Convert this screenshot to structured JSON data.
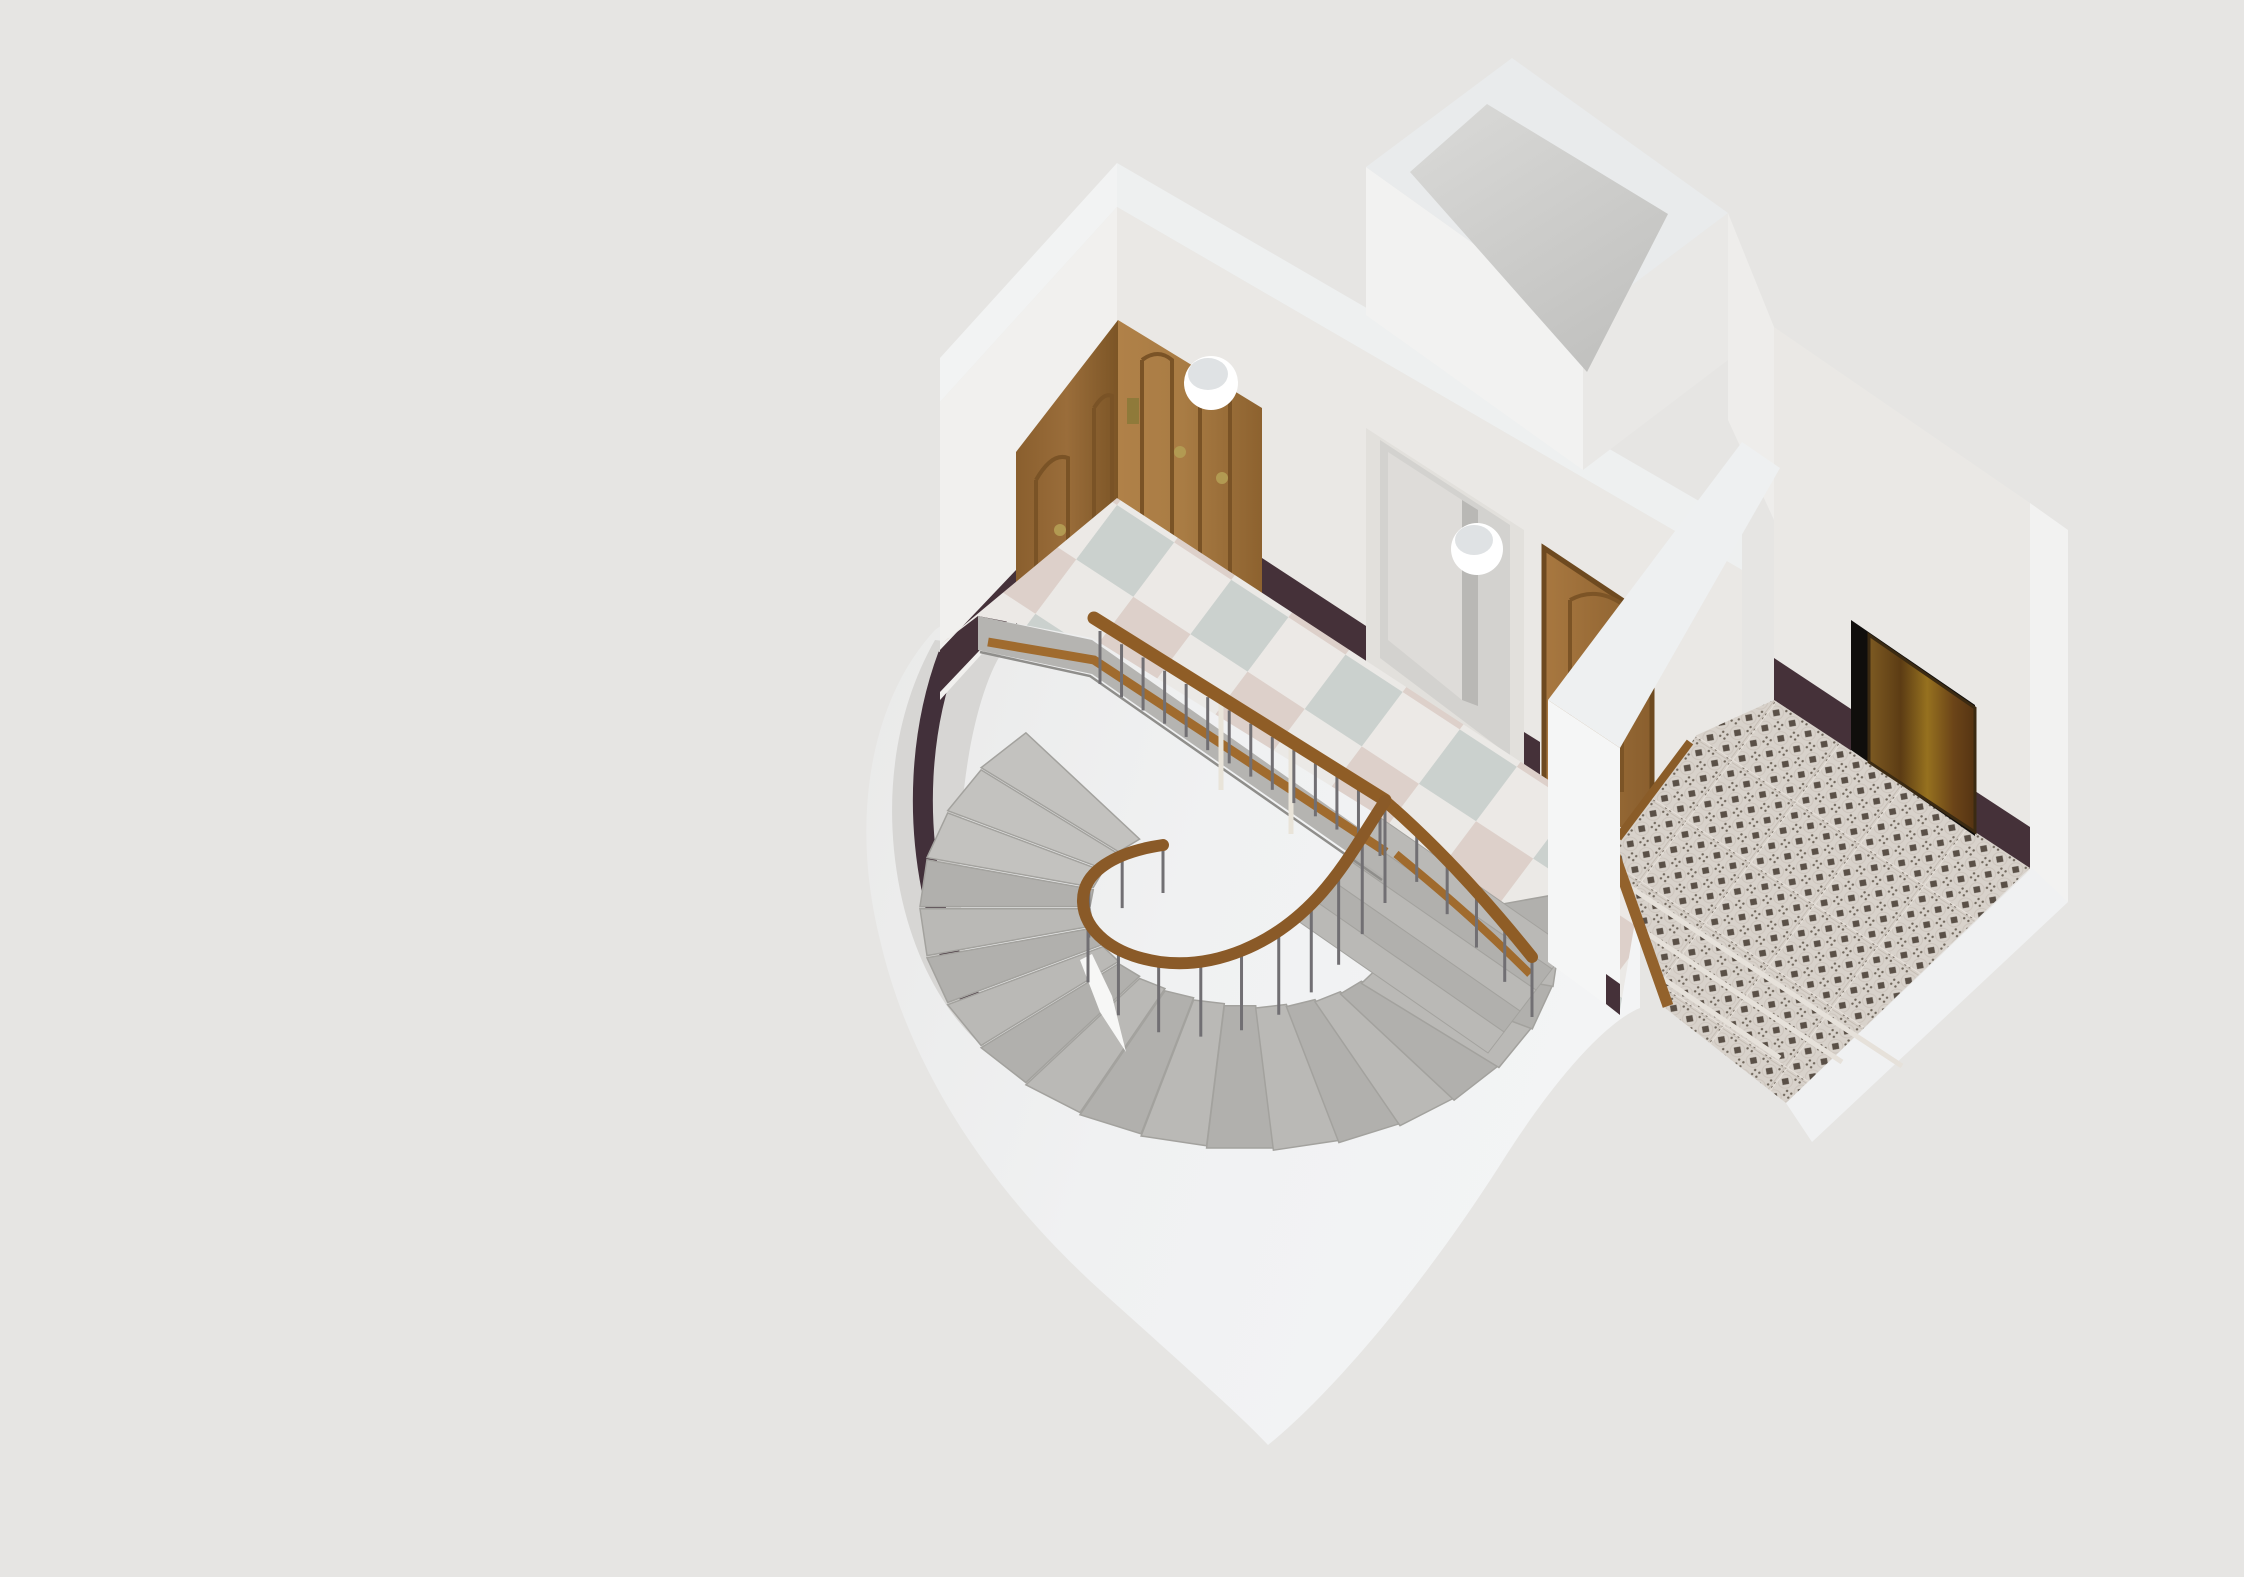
{
  "scene": {
    "type": "isometric architectural 3D render",
    "subject": "Cutaway of a historic apartment-building stairwell landing with a curved stair around an open well, corner wardrobe, open white door, oak apartment door, dark entrance door and ornamental tiled entry",
    "background": "#e6e5e3",
    "palette": {
      "wallLight": "#f1f0ee",
      "wallMid": "#eae8e5",
      "wallTop": "#f2f3f3",
      "wallCut": "#f5f6f6",
      "wallCutTop": "#eef0f1",
      "shaftRim": "#e9ebec",
      "shaftInnerLight": "#dadad8",
      "shaftInnerDark": "#c2c2c0",
      "curvedWall": "#d7d6d4",
      "outerMass": "#f0f1f2",
      "baseboard": "#453139",
      "wainscot": "#42303a",
      "checkerWhite": "#ebe9e6",
      "checkerPink": "#ddd0ca",
      "checkerSage": "#cbd1ce",
      "slabEdge": "#b5b4b1",
      "stepLight": "#c3c2bf",
      "stepA": "#bab9b6",
      "stepB": "#b1b0ad",
      "handrail": "#8f5d26",
      "baseRail": "#a06b2e",
      "baluster": "#716f73",
      "newelCream": "#e9e4d9",
      "woodLight": "#a97c44",
      "woodMid": "#9a6d3a",
      "woodDark": "#7c5526",
      "doorFrameWhite": "#e2e0dc",
      "doorLeaf": "#dedcd9",
      "doorReveal": "#d3d2cf",
      "entranceDoorMid": "#8a5c20",
      "entranceDoorDark": "#5c3c14",
      "recessBlack": "#100e0c",
      "entryTileBase": "#d8d2cb",
      "entryTileMotif": "#5a5047",
      "threshold": "#93622c",
      "brass": "#b29a52",
      "lampWhite": "#ffffff",
      "lampCap": "#dfe2e4"
    },
    "lamps": [
      {
        "name": "globe-lamp-1",
        "cx": 1211,
        "cy": 383,
        "r": 27
      },
      {
        "name": "globe-lamp-2",
        "cx": 1477,
        "cy": 549,
        "r": 26
      }
    ],
    "staircase": {
      "form": "curved winder flight wrapping a hairpin-shaped open well",
      "fanSteps": 20,
      "rightFlightSteps": 5,
      "direction": "descends clockwise from the landing"
    },
    "railing": {
      "straightBalusters": 14,
      "curvedBalusters": 13,
      "descendingBalusters": 6,
      "newelPosts": 2
    },
    "floors": {
      "hall": "checkerboard marble tiles (white / pale pink / pale sage)",
      "entry": "ornamental cement tiles with dark floret motif, three shallow steps"
    },
    "doors": [
      {
        "name": "corner-wardrobe",
        "desc": "built-in corner wardrobe, oak panels, brass fittings"
      },
      {
        "name": "open-doorway",
        "desc": "white framed doorway, door standing open inward"
      },
      {
        "name": "apartment-door",
        "desc": "oak panel apartment door with brass handle"
      },
      {
        "name": "entrance-door",
        "desc": "dark rustic wood entrance door in a recess"
      }
    ]
  }
}
